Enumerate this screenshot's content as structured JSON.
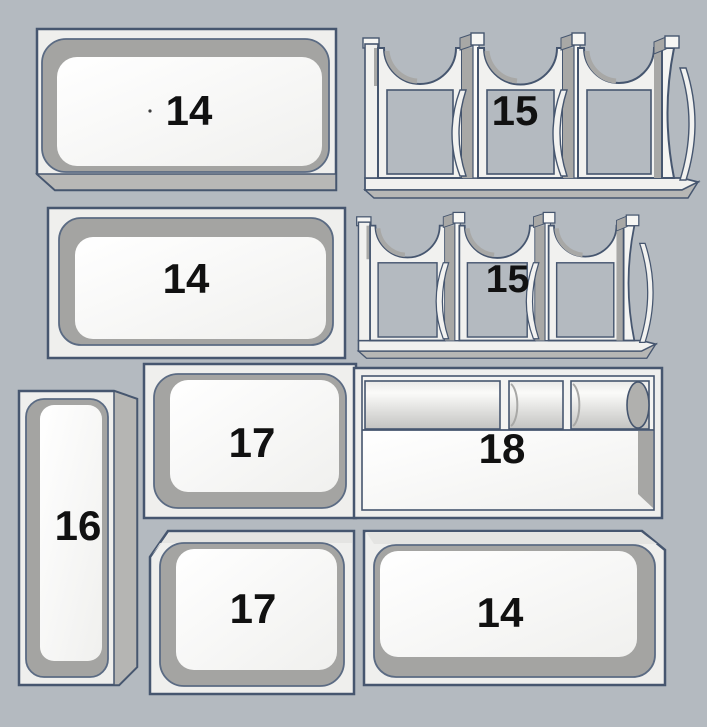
{
  "scene": {
    "description": "3D render of nine labeled organizer bin inserts arranged in a grid",
    "background_color": "#b4bac0",
    "outline_color": "#46566f",
    "body_color": "#f1f1ef",
    "cavity_color": "#a6a6a4",
    "floor_color": "#fbfbf9",
    "shadow_color": "#b8b8b6",
    "label_color": "#111111"
  },
  "parts": [
    {
      "id": "tray-14-top-left",
      "type": "open-tray",
      "label": "14"
    },
    {
      "id": "holder-15-top-right",
      "type": "cradle-holder",
      "label": "15"
    },
    {
      "id": "tray-14-middle-left",
      "type": "open-tray",
      "label": "14"
    },
    {
      "id": "holder-15-middle-right",
      "type": "cradle-holder",
      "label": "15"
    },
    {
      "id": "tray-16-tall-left",
      "type": "tall-narrow-tray",
      "label": "16"
    },
    {
      "id": "tray-17-upper",
      "type": "open-tray",
      "label": "17"
    },
    {
      "id": "tray-18-cylinders",
      "type": "cylinder-tray",
      "label": "18"
    },
    {
      "id": "tray-17-lower",
      "type": "open-tray",
      "label": "17"
    },
    {
      "id": "tray-14-bottom-right",
      "type": "open-tray",
      "label": "14"
    }
  ]
}
